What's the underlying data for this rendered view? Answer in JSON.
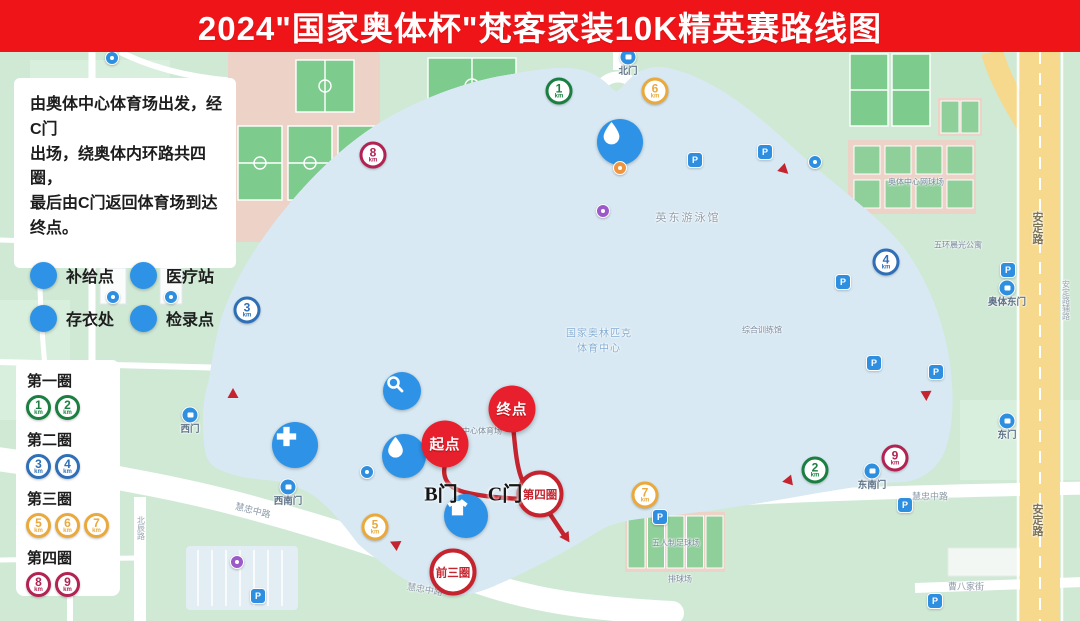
{
  "banner": {
    "title": "2024\"国家奥体杯\"梵客家装10K精英赛路线图",
    "bg": "#ee1418"
  },
  "info_panel": {
    "lines": [
      "由奥体中心体育场出发，经C门",
      "出场，绕奥体内环路共四圈，",
      "最后由C门返回体育场到达终点。"
    ],
    "legend": [
      {
        "icon": "water-drop-icon",
        "label": "补给点"
      },
      {
        "icon": "medical-cross-icon",
        "label": "医疗站"
      },
      {
        "icon": "shirt-icon",
        "label": "存衣处"
      },
      {
        "icon": "magnifier-icon",
        "label": "检录点"
      }
    ]
  },
  "laps_panel": {
    "groups": [
      {
        "name": "第一圈",
        "color": "#1a7f41",
        "kms": [
          1,
          2
        ]
      },
      {
        "name": "第二圈",
        "color": "#2e6fb7",
        "kms": [
          3,
          4
        ]
      },
      {
        "name": "第三圈",
        "color": "#eaa93c",
        "kms": [
          5,
          6,
          7
        ]
      },
      {
        "name": "第四圈",
        "color": "#b22253",
        "kms": [
          8,
          9
        ]
      }
    ]
  },
  "map": {
    "route_color": "#c5242e",
    "start_label": "起点",
    "finish_label": "终点",
    "lap4_label": "第四圈",
    "lap123_label": "前三圈",
    "gate_b": "B门",
    "gate_c": "C门",
    "km_markers": [
      {
        "km": 1,
        "x": 559,
        "y": 91,
        "color": "#1a7f41"
      },
      {
        "km": 2,
        "x": 815,
        "y": 470,
        "color": "#1a7f41"
      },
      {
        "km": 3,
        "x": 247,
        "y": 310,
        "color": "#2e6fb7"
      },
      {
        "km": 4,
        "x": 886,
        "y": 262,
        "color": "#2e6fb7"
      },
      {
        "km": 5,
        "x": 375,
        "y": 527,
        "color": "#eaa93c"
      },
      {
        "km": 6,
        "x": 655,
        "y": 91,
        "color": "#eaa93c"
      },
      {
        "km": 7,
        "x": 645,
        "y": 495,
        "color": "#eaa93c"
      },
      {
        "km": 8,
        "x": 373,
        "y": 155,
        "color": "#b22253"
      },
      {
        "km": 9,
        "x": 895,
        "y": 458,
        "color": "#b22253"
      }
    ],
    "special": {
      "start": {
        "x": 445,
        "y": 444
      },
      "finish": {
        "x": 512,
        "y": 409
      },
      "lap4": {
        "x": 540,
        "y": 494
      },
      "lap123": {
        "x": 453,
        "y": 572
      },
      "gate_b": {
        "x": 441,
        "y": 492
      },
      "gate_c": {
        "x": 505,
        "y": 492
      }
    },
    "station_icons": [
      {
        "icon": "magnifier-icon",
        "x": 402,
        "y": 391,
        "d": 38
      },
      {
        "icon": "water-drop-icon",
        "x": 404,
        "y": 456,
        "d": 44
      },
      {
        "icon": "medical-cross-icon",
        "x": 295,
        "y": 445,
        "d": 46
      },
      {
        "icon": "shirt-icon",
        "x": 466,
        "y": 516,
        "d": 44
      },
      {
        "icon": "water-drop-icon",
        "x": 620,
        "y": 142,
        "d": 46
      }
    ],
    "gates": [
      {
        "label": "北门",
        "x": 628,
        "y": 57
      },
      {
        "label": "西门",
        "x": 190,
        "y": 415
      },
      {
        "label": "西南门",
        "x": 288,
        "y": 487
      },
      {
        "label": "东南门",
        "x": 872,
        "y": 471
      },
      {
        "label": "奥体东门",
        "x": 1007,
        "y": 288
      },
      {
        "label": "东门",
        "x": 1007,
        "y": 421
      }
    ],
    "parking_icons": [
      [
        695,
        160
      ],
      [
        765,
        152
      ],
      [
        843,
        282
      ],
      [
        874,
        363
      ],
      [
        936,
        372
      ],
      [
        1008,
        270
      ],
      [
        660,
        517
      ],
      [
        905,
        505
      ],
      [
        935,
        601
      ],
      [
        258,
        596
      ]
    ],
    "small_pois": [
      {
        "x": 603,
        "y": 211,
        "color": "#9b59c9"
      },
      {
        "x": 237,
        "y": 562,
        "color": "#9b59c9"
      },
      {
        "x": 815,
        "y": 162,
        "color": "#2e8fe0"
      },
      {
        "x": 367,
        "y": 472,
        "color": "#2e8fe0"
      },
      {
        "x": 620,
        "y": 168,
        "color": "#f0953f"
      },
      {
        "x": 112,
        "y": 58,
        "color": "#2e8fe0"
      },
      {
        "x": 113,
        "y": 297,
        "color": "#2e8fe0"
      },
      {
        "x": 171,
        "y": 297,
        "color": "#2e8fe0"
      }
    ],
    "labels": [
      {
        "t": "英东游泳馆",
        "x": 688,
        "y": 217,
        "c": "building"
      },
      {
        "t": "综合训练馆",
        "x": 762,
        "y": 330,
        "c": "tiny"
      },
      {
        "t": "国家奥林匹克",
        "x": 599,
        "y": 332,
        "c": "lake"
      },
      {
        "t": "体育中心",
        "x": 599,
        "y": 347,
        "c": "lake"
      },
      {
        "t": "中心体育场",
        "x": 482,
        "y": 431,
        "c": "tiny"
      },
      {
        "t": "奥体中心网球场",
        "x": 916,
        "y": 182,
        "c": "tiny"
      },
      {
        "t": "五环晨光公寓",
        "x": 958,
        "y": 245,
        "c": "tiny"
      },
      {
        "t": "五人制足球场",
        "x": 676,
        "y": 543,
        "c": "tiny"
      },
      {
        "t": "排球场",
        "x": 680,
        "y": 579,
        "c": "tiny"
      },
      {
        "t": "安定路",
        "x": 1037,
        "y": 228,
        "c": "road-v"
      },
      {
        "t": "安定路",
        "x": 1037,
        "y": 520,
        "c": "road-v"
      },
      {
        "t": "安定路辅路",
        "x": 1066,
        "y": 300,
        "c": "road-v-tiny"
      },
      {
        "t": "北辰路",
        "x": 141,
        "y": 528,
        "c": "road-v-tiny"
      },
      {
        "t": "慧忠中路",
        "x": 253,
        "y": 510,
        "c": "road",
        "r": 14
      },
      {
        "t": "慧忠中路",
        "x": 425,
        "y": 589,
        "c": "road",
        "r": 10
      },
      {
        "t": "慧忠中路",
        "x": 930,
        "y": 496,
        "c": "road"
      },
      {
        "t": "曹八家街",
        "x": 966,
        "y": 586,
        "c": "road"
      }
    ]
  }
}
